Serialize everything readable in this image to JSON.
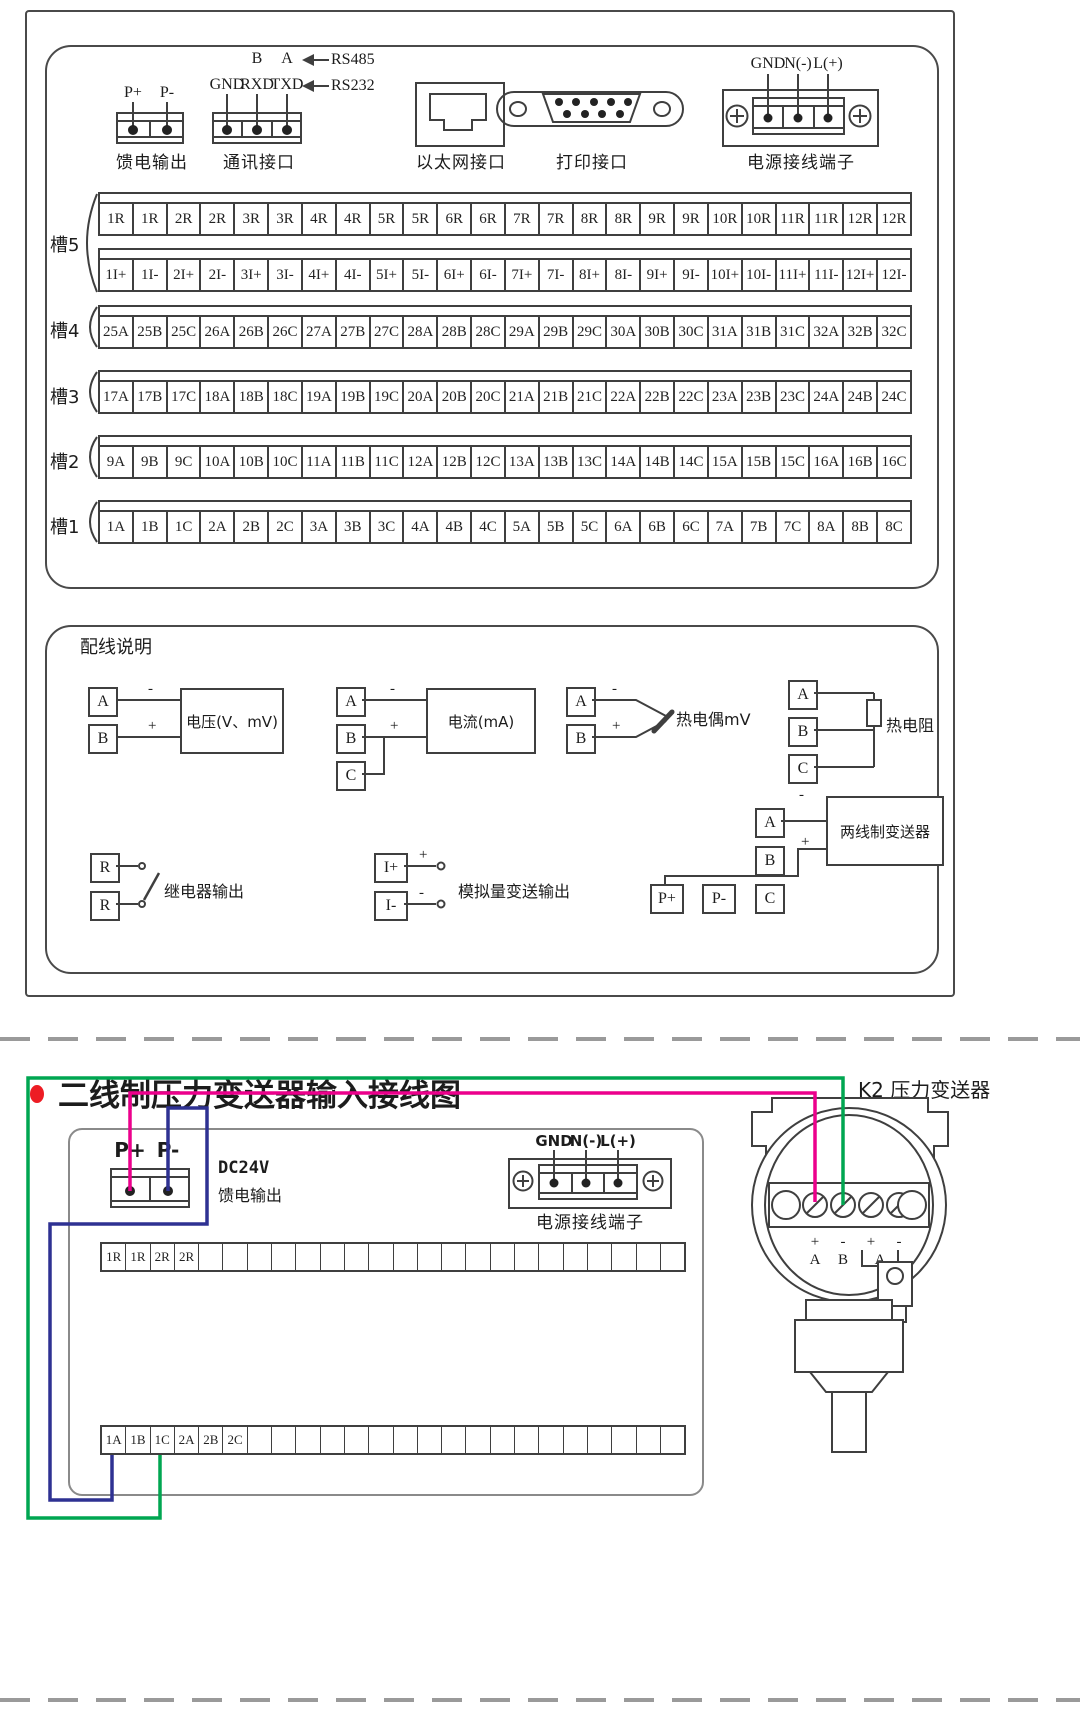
{
  "top": {
    "feed": {
      "p1": "P+",
      "p2": "P-",
      "caption": "馈电输出"
    },
    "comm": {
      "b": "B",
      "a": "A",
      "gnd": "GND",
      "rxd": "RXD",
      "txd": "TXD",
      "rs485": "RS485",
      "rs232": "RS232",
      "caption": "通讯接口"
    },
    "eth": {
      "caption": "以太网接口"
    },
    "prn": {
      "caption": "打印接口"
    },
    "pwr": {
      "gnd": "GND",
      "n": "N(-)",
      "l": "L(+)",
      "caption": "电源接线端子"
    },
    "slots": [
      {
        "name": "槽5",
        "row1": [
          "1R",
          "1R",
          "2R",
          "2R",
          "3R",
          "3R",
          "4R",
          "4R",
          "5R",
          "5R",
          "6R",
          "6R",
          "7R",
          "7R",
          "8R",
          "8R",
          "9R",
          "9R",
          "10R",
          "10R",
          "11R",
          "11R",
          "12R",
          "12R"
        ],
        "row2": [
          "1I+",
          "1I-",
          "2I+",
          "2I-",
          "3I+",
          "3I-",
          "4I+",
          "4I-",
          "5I+",
          "5I-",
          "6I+",
          "6I-",
          "7I+",
          "7I-",
          "8I+",
          "8I-",
          "9I+",
          "9I-",
          "10I+",
          "10I-",
          "11I+",
          "11I-",
          "12I+",
          "12I-"
        ]
      },
      {
        "name": "槽4",
        "row1": [
          "25A",
          "25B",
          "25C",
          "26A",
          "26B",
          "26C",
          "27A",
          "27B",
          "27C",
          "28A",
          "28B",
          "28C",
          "29A",
          "29B",
          "29C",
          "30A",
          "30B",
          "30C",
          "31A",
          "31B",
          "31C",
          "32A",
          "32B",
          "32C"
        ]
      },
      {
        "name": "槽3",
        "row1": [
          "17A",
          "17B",
          "17C",
          "18A",
          "18B",
          "18C",
          "19A",
          "19B",
          "19C",
          "20A",
          "20B",
          "20C",
          "21A",
          "21B",
          "21C",
          "22A",
          "22B",
          "22C",
          "23A",
          "23B",
          "23C",
          "24A",
          "24B",
          "24C"
        ]
      },
      {
        "name": "槽2",
        "row1": [
          "9A",
          "9B",
          "9C",
          "10A",
          "10B",
          "10C",
          "11A",
          "11B",
          "11C",
          "12A",
          "12B",
          "12C",
          "13A",
          "13B",
          "13C",
          "14A",
          "14B",
          "14C",
          "15A",
          "15B",
          "15C",
          "16A",
          "16B",
          "16C"
        ]
      },
      {
        "name": "槽1",
        "row1": [
          "1A",
          "1B",
          "1C",
          "2A",
          "2B",
          "2C",
          "3A",
          "3B",
          "3C",
          "4A",
          "4B",
          "4C",
          "5A",
          "5B",
          "5C",
          "6A",
          "6B",
          "6C",
          "7A",
          "7B",
          "7C",
          "8A",
          "8B",
          "8C"
        ]
      }
    ]
  },
  "wiring": {
    "title": "配线说明",
    "voltage": {
      "a": "A",
      "b": "B",
      "minus": "-",
      "plus": "+",
      "label": "电压(V、mV)"
    },
    "current": {
      "a": "A",
      "b": "B",
      "c": "C",
      "minus": "-",
      "plus": "+",
      "label": "电流(mA)"
    },
    "thermocouple": {
      "a": "A",
      "b": "B",
      "minus": "-",
      "plus": "+",
      "label": "热电偶mV"
    },
    "rtd": {
      "a": "A",
      "b": "B",
      "c": "C",
      "label": "热电阻"
    },
    "relay": {
      "r1": "R",
      "r2": "R",
      "label": "继电器输出"
    },
    "analog": {
      "ip": "I+",
      "im": "I-",
      "plus": "+",
      "minus": "-",
      "label": "模拟量变送输出"
    },
    "twowire": {
      "a": "A",
      "b": "B",
      "c": "C",
      "pp": "P+",
      "pm": "P-",
      "minus": "-",
      "plus": "+",
      "label": "两线制变送器"
    }
  },
  "bottom": {
    "title": "二线制压力变送器输入接线图",
    "k2_label": "K2 压力变送器",
    "transmitter": {
      "signs": [
        "+",
        "-",
        "+",
        "-"
      ],
      "letters": [
        "A",
        "B",
        "A"
      ]
    },
    "feed": {
      "p1": "P+",
      "p2": "P-",
      "line1": "DC24V",
      "line2": "馈电输出"
    },
    "pwr": {
      "gnd": "GND",
      "n": "N(-)",
      "l": "L(+)",
      "caption": "电源接线端子"
    },
    "strip1": [
      "1R",
      "1R",
      "2R",
      "2R",
      "",
      "",
      "",
      "",
      "",
      "",
      "",
      "",
      "",
      "",
      "",
      "",
      "",
      "",
      "",
      "",
      "",
      "",
      "",
      ""
    ],
    "strip2": [
      "1A",
      "1B",
      "1C",
      "2A",
      "2B",
      "2C",
      "",
      "",
      "",
      "",
      "",
      "",
      "",
      "",
      "",
      "",
      "",
      "",
      "",
      "",
      "",
      "",
      "",
      ""
    ],
    "colors": {
      "green": "#00A651",
      "pink": "#EC008C",
      "blue": "#2E3192",
      "bullet": "#ED1C24"
    }
  }
}
